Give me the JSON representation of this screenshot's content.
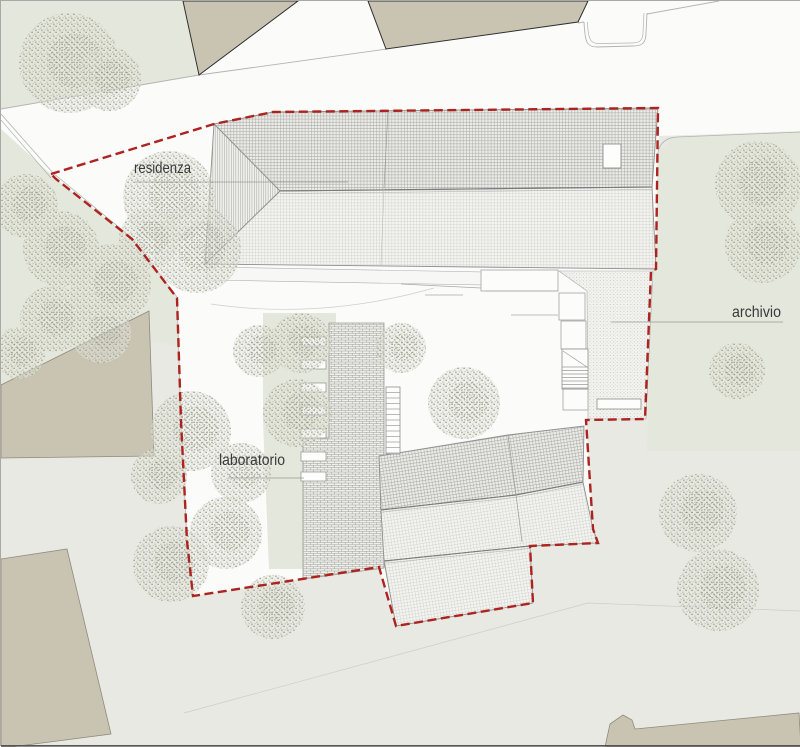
{
  "title": "Planimetria di progetto - site plan",
  "colors": {
    "paper": "#fbfbfa",
    "ground_gray": "#e9e9e3",
    "green": "#e4e7dc",
    "beige": "#c9c3b1",
    "beige_stroke": "#8f8a7c",
    "dark_stroke": "#2f2f2f",
    "road_line": "#b3b3af",
    "faint_line": "#cdcdc9",
    "roof_line": "#8f8f8f",
    "ridge_line": "#7a7a7a",
    "boundary_red": "#ab241f",
    "text": "#3a3a3a"
  },
  "labels": [
    {
      "id": "residenza",
      "text": "residenza",
      "x": 133,
      "y": 172,
      "length": 57,
      "font": 16,
      "leader": [
        134,
        181,
        347,
        181
      ]
    },
    {
      "id": "archivio",
      "text": "archivio",
      "x": 731,
      "y": 316,
      "length": 49,
      "font": 16,
      "leader": [
        610,
        321,
        782,
        321
      ]
    },
    {
      "id": "laboratorio",
      "text": "laboratorio",
      "x": 218,
      "y": 464,
      "length": 66,
      "font": 16,
      "leader": [
        227,
        477,
        303,
        477
      ]
    }
  ],
  "boundary": {
    "points": "50,173 213,123 272,111 657,107 655,268 650,270 644,418 585,419 592,528 597,542 529,545 532,602 395,625 378,566 192,595 186,540 180,420 176,297 131,238 55,178",
    "dash": "9 4.5",
    "width": 2.4
  },
  "regions": {
    "outside_gray": "0,128 55,178 131,238 176,297 180,420 186,540 192,595 378,566 395,625 532,602 529,545 597,543 592,528 585,419 644,418 650,270 655,268 658,135 800,130 800,746 0,746",
    "green_topleft": "0,0 182,0 197,74 0,108",
    "green_left": "0,128 55,178 131,238 176,297 179,345 150,340 0,385",
    "green_right": "657,152 672,136 800,131 800,450 646,450 651,280",
    "site_white": "50,173 213,123 272,111 657,107 655,268 650,270 644,418 585,419 592,528 597,542 529,545 532,602 395,625 378,566 192,595 186,540 180,420 176,297 131,238 55,178",
    "court_green": "262,312 335,312 335,568 268,568 262,420"
  },
  "background_buildings": [
    {
      "name": "context-building-north-1",
      "points": "182,0 297,0 198,74",
      "dark": true
    },
    {
      "name": "context-building-north-2",
      "points": "367,0 587,0 577,21 385,48",
      "dark": true
    },
    {
      "name": "context-building-west",
      "points": "0,384 148,310 153,455 0,457",
      "dark": false
    },
    {
      "name": "context-building-southwest",
      "points": "0,558 66,548 110,733 10,746 0,746",
      "dark": false
    },
    {
      "name": "context-building-south",
      "points": "604,746 609,723 622,714 631,719 634,728 798,712 800,746",
      "dark": false
    }
  ],
  "roads": {
    "curb_lines": [
      "0,108 198,74 386,48",
      "577,22 583,21",
      "646,13 718,0"
    ],
    "driveway_notch_outer": "M583,21 C584,40 585,46 596,46 L632,45 C642,45 645,41 645,32 L646,12",
    "driveway_notch_inner": "M586.5,21 C587,37 589,42.5 597,42.5 L631,42 C639.5,42 642,38.5 642,31 L643,12",
    "green_right_top_edge": "M656,160 Q656,137 676,136 L800,131",
    "path_edge_left": "0,113 52,172 131,237 176,296 180,420 186,540 192,594",
    "path_edge_left2": "0,119 50,177",
    "faint_path_bottom": "183,712 587,602 800,610",
    "court_curve": "M210,303 Q320,319 433,287"
  },
  "residenza": {
    "upper_slope": "213,123 272,111 657,107 651,186 279,190",
    "lower_slope": "279,190 651,186 655,268 204,263",
    "hip_face": "213,123 279,190 204,263",
    "ridge": [
      279,
      190,
      651,
      186
    ],
    "ridge2": [
      279,
      192.5,
      651,
      188.5
    ],
    "seam_upper": [
      387,
      109,
      383,
      187
    ],
    "seam_lower": [
      383,
      187,
      380,
      264
    ],
    "skylight": [
      602,
      143,
      18,
      24
    ],
    "eave_strip": "206,266 540,272 540,285 206,279"
  },
  "laboratorio": {
    "row1_dense": "378,455 507,434 583,425 582,481 515,494 380,509",
    "row2_light": "380,509 515,494 582,481 592,528 597,542 529,545 383,560",
    "row3_light": "383,560 529,545 532,602 395,625",
    "ridge_dbl": [
      "380,509 515,494 582,481",
      "380,511.3 515,496.3 582,483.3"
    ],
    "eave_dbl": [
      "383,560 529,545",
      "383,562.3 529,547.3"
    ],
    "seams": [
      [
        507,
        434,
        515,
        494
      ],
      [
        515,
        494,
        521,
        541
      ]
    ],
    "brick_strip": "328,322 383,322 383,567 302,578 302,437 328,437"
  },
  "courtyard": {
    "planters": {
      "x": 300,
      "w": 25,
      "h": 9,
      "ys": [
        336,
        359,
        382,
        405,
        428,
        451,
        471
      ]
    },
    "stair_west": {
      "rect": [
        385,
        386,
        14,
        67
      ],
      "rung_step": 5.5
    },
    "court_rects": [
      [
        480,
        269,
        77,
        21
      ],
      [
        558,
        292,
        26,
        27
      ],
      [
        560,
        320,
        25,
        28
      ],
      [
        562,
        388,
        25,
        21
      ]
    ],
    "wall_lines": [
      [
        485,
        290,
        557,
        290
      ],
      [
        510,
        314,
        557,
        314
      ],
      [
        400,
        283,
        480,
        287
      ],
      [
        424,
        294,
        462,
        294
      ]
    ],
    "stair_east": {
      "rect": [
        561,
        348,
        26,
        40
      ],
      "diag": [
        562,
        350,
        586,
        366
      ],
      "rung_from": 366,
      "rung_to": 387,
      "rung_step": 3.5
    },
    "bench": [
      596,
      398,
      44,
      10
    ]
  },
  "archivio_court": {
    "stipple": "558,270 652,270 645,418 587,418 586,290"
  },
  "trees": [
    [
      68,
      62,
      50
    ],
    [
      108,
      78,
      32
    ],
    [
      25,
      205,
      32
    ],
    [
      60,
      248,
      38
    ],
    [
      110,
      283,
      40
    ],
    [
      52,
      318,
      33
    ],
    [
      18,
      352,
      26
    ],
    [
      100,
      332,
      30
    ],
    [
      168,
      196,
      46
    ],
    [
      196,
      248,
      44
    ],
    [
      148,
      238,
      30
    ],
    [
      190,
      430,
      40
    ],
    [
      158,
      475,
      28
    ],
    [
      225,
      532,
      36
    ],
    [
      170,
      563,
      38
    ],
    [
      272,
      606,
      32
    ],
    [
      240,
      472,
      30
    ],
    [
      300,
      342,
      30
    ],
    [
      296,
      412,
      34
    ],
    [
      258,
      350,
      26
    ],
    [
      400,
      347,
      25
    ],
    [
      463,
      402,
      36
    ],
    [
      757,
      183,
      43
    ],
    [
      762,
      244,
      38
    ],
    [
      736,
      370,
      28
    ],
    [
      697,
      512,
      39
    ],
    [
      717,
      589,
      41
    ]
  ]
}
